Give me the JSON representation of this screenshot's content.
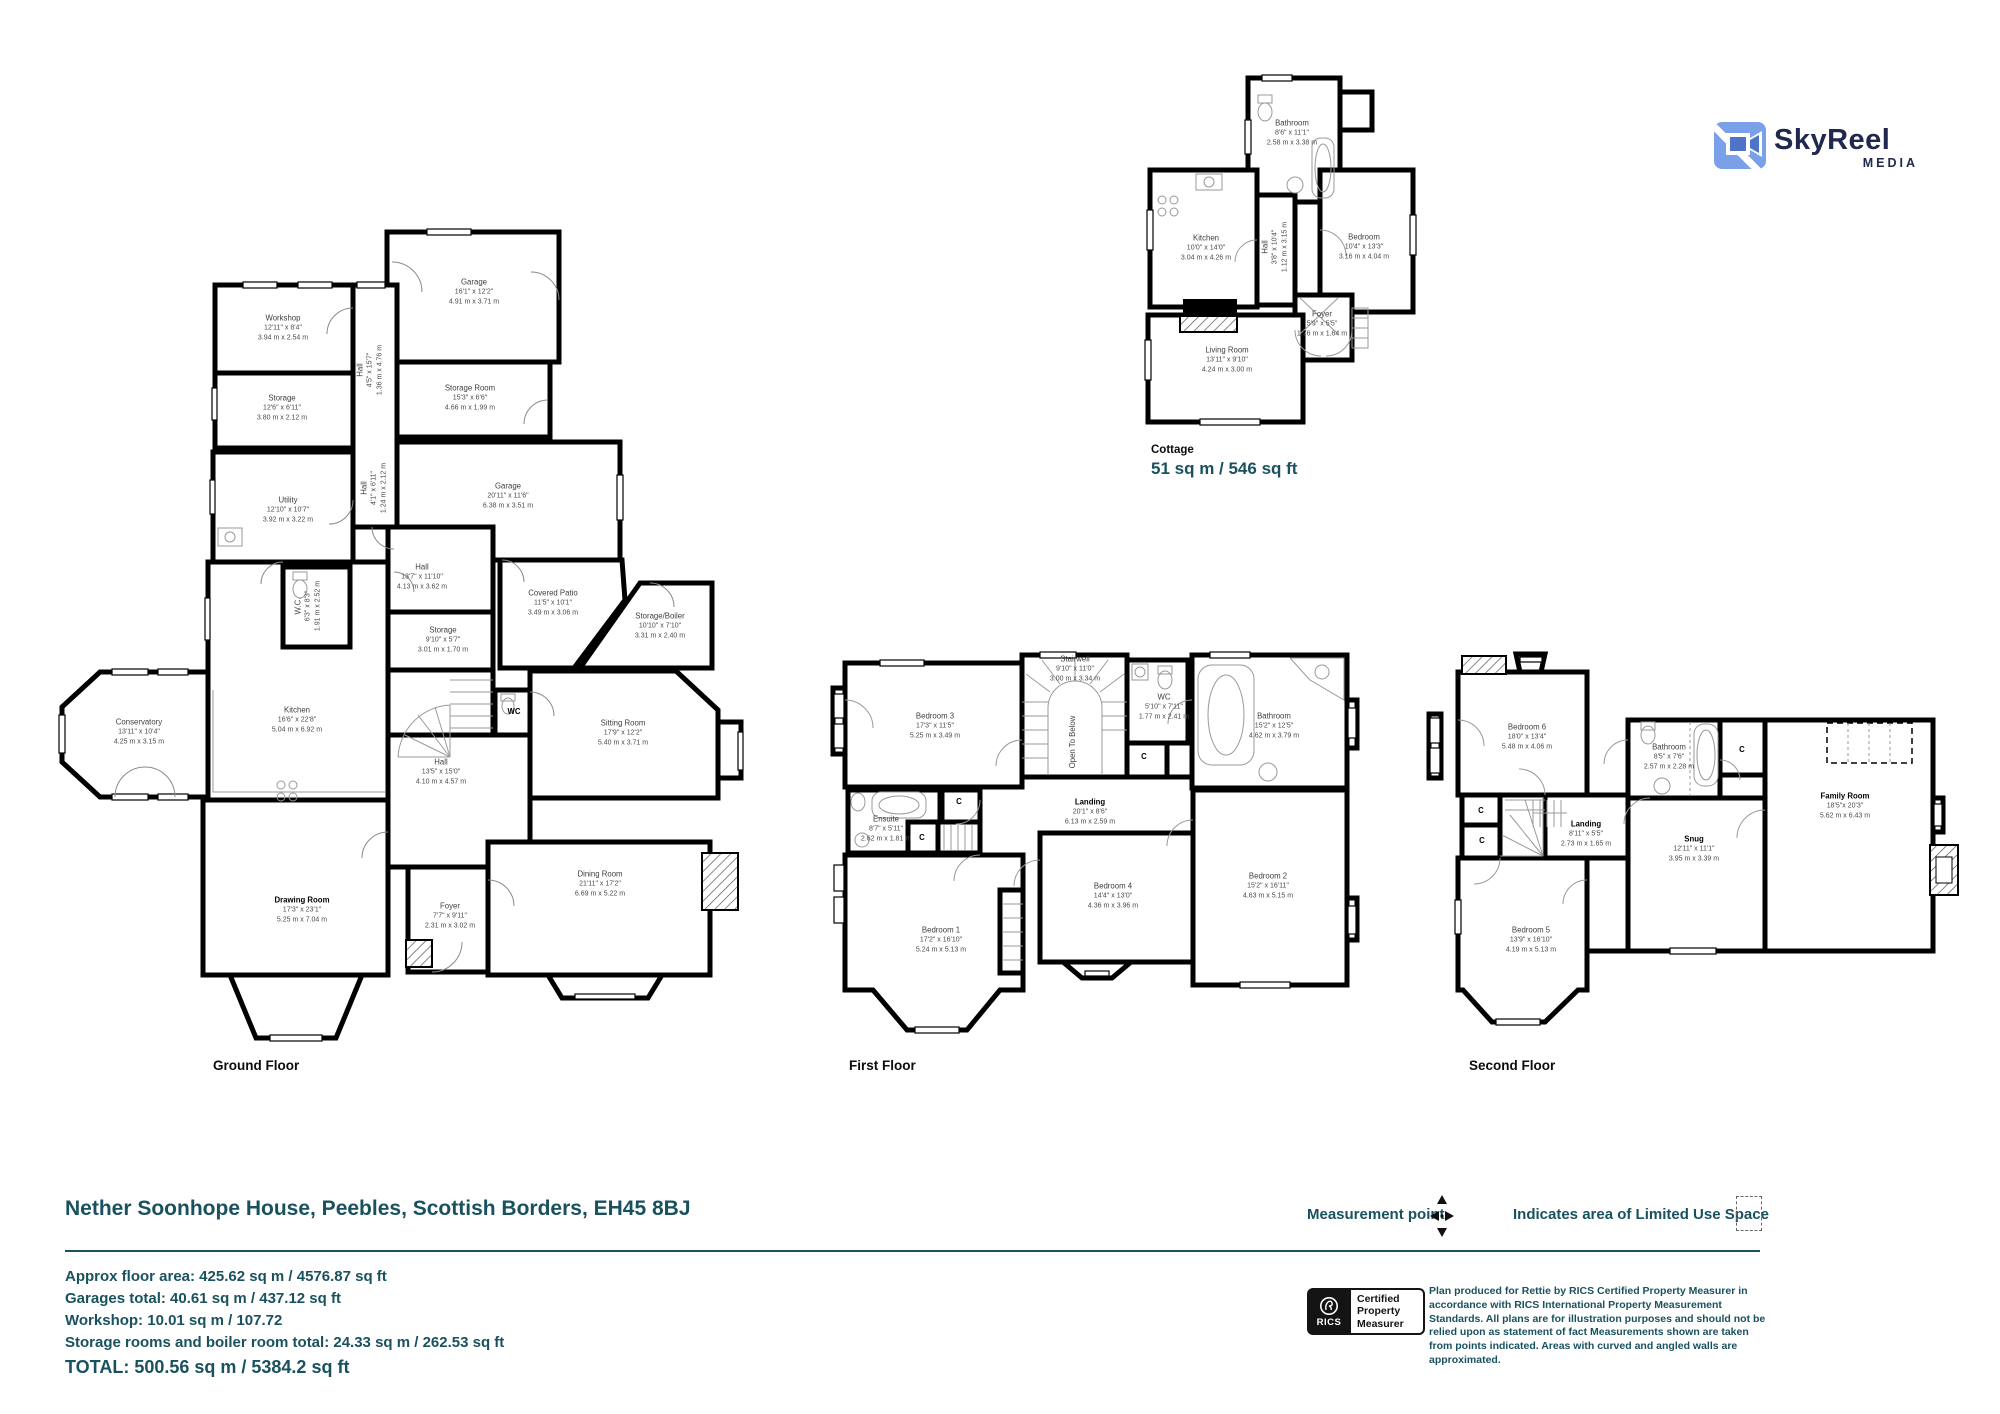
{
  "brand": {
    "name": "SkyReel",
    "sub": "MEDIA"
  },
  "title": "Nether Soonhope House, Peebles, Scottish Borders, EH45 8BJ",
  "summary": {
    "lines": [
      "Approx floor area: 425.62 sq m / 4576.87 sq ft",
      "Garages total: 40.61 sq m / 437.12 sq ft",
      "Workshop: 10.01 sq m / 107.72",
      "Storage rooms and boiler room total: 24.33 sq m / 262.53 sq ft"
    ],
    "total": "TOTAL: 500.56 sq m / 5384.2 sq ft"
  },
  "legend": {
    "measurement_point": "Measurement point",
    "limited_use": "Indicates area of  Limited Use Space"
  },
  "rics": {
    "org": "RICS",
    "badge_line1": "Certified",
    "badge_line2": "Property",
    "badge_line3": "Measurer",
    "disclaimer": "Plan produced for Rettie by RICS Certified Property Measurer in accordance with RICS International Property  Measurement Standards.  All plans are for illustration purposes and should not be relied upon as statement of fact Measurements shown are taken from points indicated. Areas with curved and angled walls are approximated."
  },
  "colors": {
    "teal": "#19525e",
    "logo_blue": "#7ba0ea",
    "logo_navy": "#20294d"
  },
  "plans": {
    "ground": {
      "label": "Ground Floor",
      "rooms": {
        "workshop": {
          "n": "Workshop",
          "f": "12'11\" x 8'4\"",
          "m": "3.94 m x 2.54 m"
        },
        "storage1": {
          "n": "Storage",
          "f": "12'6\" x 6'11\"",
          "m": "3.80 m x 2.12 m"
        },
        "hall1": {
          "n": "Hall",
          "f": "4'5\" x 15'7\"",
          "m": "1.36 m x 4.76 m"
        },
        "garage1": {
          "n": "Garage",
          "f": "16'1\" x 12'2\"",
          "m": "4.91 m x 3.71 m"
        },
        "storageroom": {
          "n": "Storage Room",
          "f": "15'3\" x 6'6\"",
          "m": "4.66 m x 1.99 m"
        },
        "utility": {
          "n": "Utility",
          "f": "12'10\" x 10'7\"",
          "m": "3.92 m x 3.22 m"
        },
        "hall2": {
          "n": "Hall",
          "f": "4'1\" x 6'11\"",
          "m": "1.24 m x 2.12 m"
        },
        "garage2": {
          "n": "Garage",
          "f": "20'11\" x 11'6\"",
          "m": "6.38 m x 3.51 m"
        },
        "wc1": {
          "n": "W.C.",
          "f": "6'3\" x 8'3\"",
          "m": "1.91 m x 2.52 m"
        },
        "hall3": {
          "n": "Hall",
          "f": "13'7\" x 11'10\"",
          "m": "4.13 m x 3.62 m"
        },
        "storage2": {
          "n": "Storage",
          "f": "9'10\" x 5'7\"",
          "m": "3.01 m x 1.70 m"
        },
        "patio": {
          "n": "Covered Patio",
          "f": "11'5\" x 10'1\"",
          "m": "3.49 m x 3.06 m"
        },
        "boiler": {
          "n": "Storage/Boiler",
          "f": "10'10\" x 7'10\"",
          "m": "3.31 m x 2.40 m"
        },
        "wc2": {
          "n": "WC"
        },
        "sitting": {
          "n": "Sitting Room",
          "f": "17'9\" x 12'2\"",
          "m": "5.40 m x 3.71 m"
        },
        "conservatory": {
          "n": "Conservatory",
          "f": "13'11\" x 10'4\"",
          "m": "4.25 m x 3.15 m"
        },
        "kitchen": {
          "n": "Kitchen",
          "f": "16'6\" x 22'8\"",
          "m": "5.04 m x 6.92 m"
        },
        "hall4": {
          "n": "Hall",
          "f": "13'5\" x 15'0\"",
          "m": "4.10 m x 4.57 m"
        },
        "drawing": {
          "n": "Drawing Room",
          "f": "17'3\" x 23'1\"",
          "m": "5.25 m x 7.04 m"
        },
        "foyer1": {
          "n": "Foyer",
          "f": "7'7\" x 9'11\"",
          "m": "2.31 m x 3.02 m"
        },
        "dining": {
          "n": "Dining Room",
          "f": "21'11\" x 17'2\"",
          "m": "6.69 m x 5.22 m"
        }
      }
    },
    "cottage": {
      "label": "Cottage",
      "area": "51 sq m / 546 sq ft",
      "rooms": {
        "cbath": {
          "n": "Bathroom",
          "f": "8'6\" x 11'1\"",
          "m": "2.58 m x 3.38 m"
        },
        "ckitchen": {
          "n": "Kitchen",
          "f": "10'0\" x 14'0\"",
          "m": "3.04 m x 4.26 m"
        },
        "chall": {
          "n": "Hall",
          "f": "3'8\" x 10'4\"",
          "m": "1.12 m x 3.15 m"
        },
        "cbed": {
          "n": "Bedroom",
          "f": "10'4\" x 13'3\"",
          "m": "3.16 m x 4.04 m"
        },
        "cfoyer": {
          "n": "Foyer",
          "f": "5'9\" x 5'5\"",
          "m": "1.76 m x 1.64 m"
        },
        "cliving": {
          "n": "Living Room",
          "f": "13'11\" x 9'10\"",
          "m": "4.24 m x 3.00 m"
        }
      }
    },
    "first": {
      "label": "First Floor",
      "rooms": {
        "bed3": {
          "n": "Bedroom 3",
          "f": "17'3\" x 11'5\"",
          "m": "5.25 m x 3.49 m"
        },
        "stairwell": {
          "n": "Stairwell",
          "f": "9'10\" x 11'0\"",
          "m": "3.00 m x 3.34 m"
        },
        "otb": {
          "n": "Open To Below"
        },
        "fwc": {
          "n": "WC",
          "f": "5'10\" x 7'11\"",
          "m": "1.77 m x 2.41 m"
        },
        "fbath": {
          "n": "Bathroom",
          "f": "15'2\" x 12'5\"",
          "m": "4.62 m x 3.79 m"
        },
        "ensuite": {
          "n": "Ensuite",
          "f": "8'7\" x 5'11\"",
          "m": "2.62 m x 1.81 m"
        },
        "flanding": {
          "n": "Landing",
          "f": "20'1\" x 8'6\"",
          "m": "6.13 m x 2.59 m"
        },
        "bed4": {
          "n": "Bedroom 4",
          "f": "14'4\" x 13'0\"",
          "m": "4.36 m x 3.96 m"
        },
        "bed2": {
          "n": "Bedroom 2",
          "f": "15'2\" x 16'11\"",
          "m": "4.63 m x 5.15 m"
        },
        "bed1": {
          "n": "Bedroom 1",
          "f": "17'2\" x 16'10\"",
          "m": "5.24 m x 5.13 m"
        }
      },
      "markers": {
        "c1": {
          "n": "C"
        },
        "c2": {
          "n": "C"
        },
        "c3": {
          "n": "C"
        }
      }
    },
    "second": {
      "label": "Second Floor",
      "rooms": {
        "bed6": {
          "n": "Bedroom 6",
          "f": "18'0\" x 13'4\"",
          "m": "5.48 m x 4.06 m"
        },
        "sbath": {
          "n": "Bathroom",
          "f": "8'5\" x 7'6\"",
          "m": "2.57 m x 2.28 m"
        },
        "family": {
          "n": "Family Room",
          "f": "18'5\"x 20'3\"",
          "m": "5.62 m x 6.43 m"
        },
        "slanding": {
          "n": "Landing",
          "f": "8'11\" x 5'5\"",
          "m": "2.73 m x 1.65 m"
        },
        "snug": {
          "n": "Snug",
          "f": "12'11\" x 11'1\"",
          "m": "3.95 m x 3.39 m"
        },
        "bed5": {
          "n": "Bedroom 5",
          "f": "13'9\" x 16'10\"",
          "m": "4.19 m x 5.13 m"
        }
      },
      "markers": {
        "c1": {
          "n": "C"
        },
        "c2": {
          "n": "C"
        },
        "c3": {
          "n": "C"
        }
      }
    }
  }
}
